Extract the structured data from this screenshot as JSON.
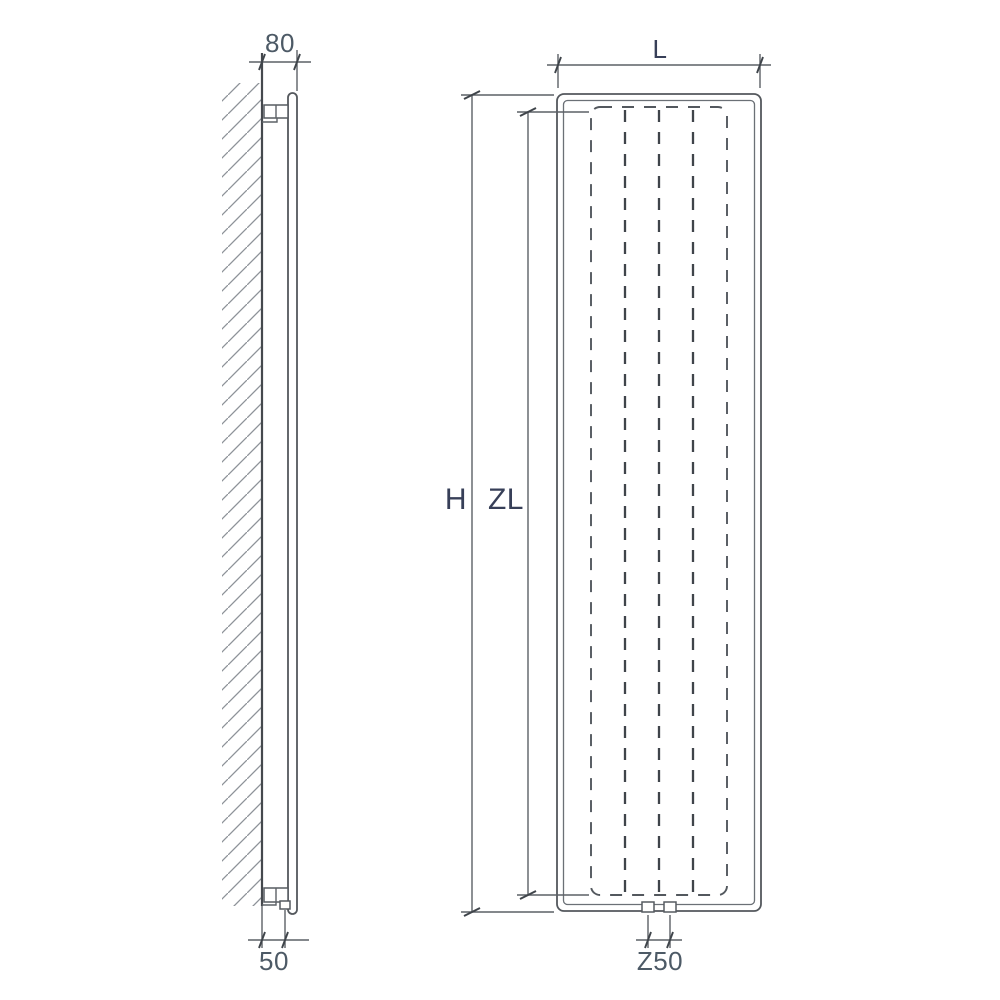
{
  "diagram": {
    "kind": "radiator-technical-drawing",
    "side_view": {
      "depth_dim": "80",
      "wall_distance_dim": "50"
    },
    "front_view": {
      "width_dim": "L",
      "height_dim": "H",
      "inner_height_dim": "ZL",
      "connection_spacing_dim": "Z50"
    },
    "colors": {
      "background": "#ffffff",
      "outline": "#54585d",
      "dashed_line": "#3f444a",
      "dimension_line": "#5c6166",
      "hatch": "#8d9298",
      "number_text": "#4d5a66",
      "letter_text": "#373f58"
    }
  }
}
